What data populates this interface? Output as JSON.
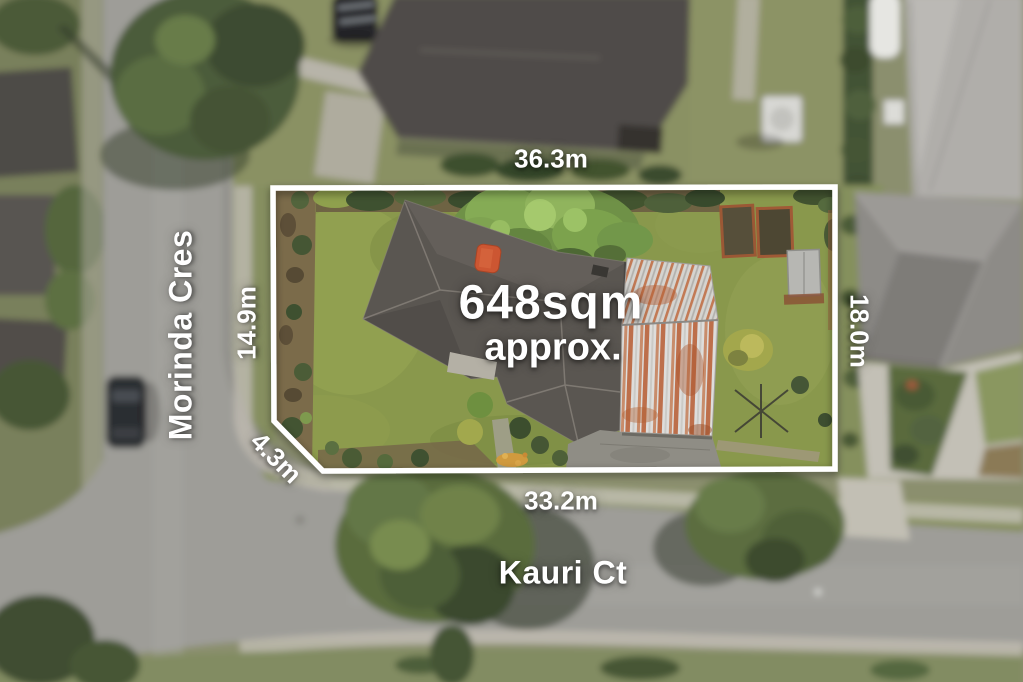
{
  "overlay": {
    "area_value": "648sqm",
    "area_qualifier": "approx.",
    "dimensions": {
      "top": "36.3m",
      "left": "14.9m",
      "corner": "4.3m",
      "bottom": "33.2m",
      "right": "18.0m"
    },
    "streets": {
      "left_vertical": "Morinda Cres",
      "bottom_horizontal": "Kauri Ct"
    },
    "colors": {
      "boundary_line": "#ffffff",
      "label_text": "#ffffff"
    }
  },
  "scene_colors": {
    "road": "#9e9d98",
    "footpath": "#c0bdb2",
    "lawn_inside": "#89984c",
    "lawn_outside": "#8b8f6e",
    "roof_dark_gray": "#5a5651",
    "metal_roof_rust": "#b85c31",
    "tree_green": "#5a6c3e",
    "chimney_orange": "#cc5632"
  }
}
